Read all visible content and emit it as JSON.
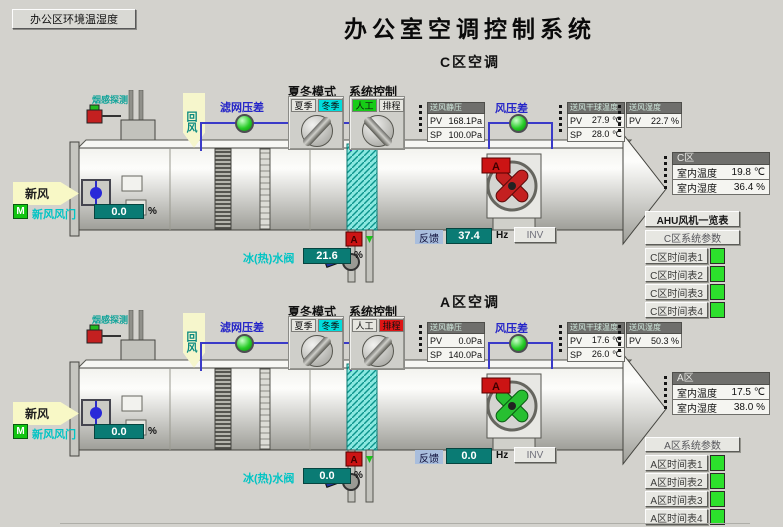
{
  "header": {
    "env_button": "办公区环境温湿度",
    "title": "办公室空调控制系统"
  },
  "labels": {
    "mode_title": "夏冬模式",
    "control_title": "系统控制",
    "summer": "夏季",
    "winter": "冬季",
    "manual": "人工",
    "schedule": "排程",
    "smoke_detector": "烟感探测",
    "return_air": "回风",
    "filter_pressure_diff": "滤网压差",
    "fresh_air": "新风",
    "fresh_air_damper": "新风风门",
    "supply_static_pressure": "送风静压",
    "air_pressure_diff": "风压差",
    "supply_dry_bulb_temp": "送风干球温度",
    "supply_humidity": "送风湿度",
    "pv": "PV",
    "sp": "SP",
    "percent": "%",
    "chilled_hot_water_valve": "冰(热)水阀",
    "feedback": "反馈",
    "hz": "Hz",
    "inv": "INV",
    "room_temp": "室内温度",
    "room_humidity": "室内湿度",
    "m_badge": "M",
    "alarm_badge": "A"
  },
  "zones": {
    "c": {
      "title": "C区空调",
      "room_name": "C区",
      "mode_active": "冬季",
      "control_active": "人工",
      "supply_pressure_pv": "168.1Pa",
      "supply_pressure_sp": "100.0Pa",
      "supply_temp_pv": "27.9 ℃",
      "supply_temp_sp": "28.0 ℃",
      "supply_humidity_pv": "22.7 %",
      "room_temp": "19.8 ℃",
      "room_humidity": "36.4 %",
      "fresh_damper_percent": "0.0",
      "water_valve_percent": "21.6",
      "feedback_hz": "37.4"
    },
    "a": {
      "title": "A区空调",
      "room_name": "A区",
      "mode_active": "冬季",
      "control_active": "排程",
      "supply_pressure_pv": "0.0Pa",
      "supply_pressure_sp": "140.0Pa",
      "supply_temp_pv": "17.6 ℃",
      "supply_temp_sp": "26.0 ℃",
      "supply_humidity_pv": "50.3 %",
      "room_temp": "17.5 ℃",
      "room_humidity": "38.0 %",
      "fresh_damper_percent": "0.0",
      "water_valve_percent": "0.0",
      "feedback_hz": "0.0"
    }
  },
  "sidebar": {
    "ahu_overview": "AHU风机一览表",
    "c_params": "C区系统参数",
    "c_schedules": [
      "C区时间表1",
      "C区时间表2",
      "C区时间表3",
      "C区时间表4"
    ],
    "a_params": "A区系统参数",
    "a_schedules": [
      "A区时间表1",
      "A区时间表2",
      "A区时间表3",
      "A区时间表4"
    ]
  },
  "colors": {
    "background": "#d3d2cd",
    "value_teal": "#0a7b74",
    "indicator_green": "#27cc27",
    "alarm_red": "#cc1414",
    "active_cyan": "#00dcdc",
    "active_green": "#16cc16",
    "wire_blue": "#3a3ac8"
  }
}
